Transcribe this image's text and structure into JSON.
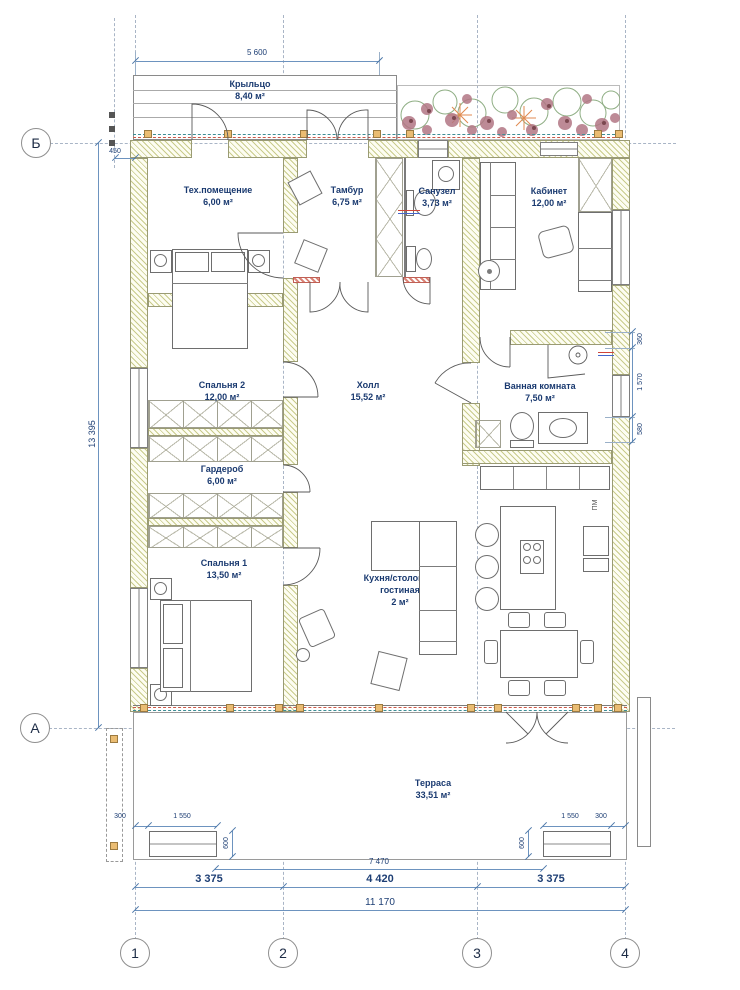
{
  "axes": {
    "horizontal": [
      "Б",
      "А"
    ],
    "vertical": [
      "1",
      "2",
      "3",
      "4"
    ]
  },
  "rooms": [
    {
      "name": "Крыльцо",
      "area": "8,40 м²"
    },
    {
      "name": "Тех.помещение",
      "area": "6,00 м²"
    },
    {
      "name": "Тамбур",
      "area": "6,75 м²"
    },
    {
      "name": "Санузел",
      "area": "3,73 м²"
    },
    {
      "name": "Кабинет",
      "area": "12,00 м²"
    },
    {
      "name": "Спальня 2",
      "area": "12,00 м²"
    },
    {
      "name": "Холл",
      "area": "15,52 м²"
    },
    {
      "name": "Ванная комната",
      "area": "7,50 м²"
    },
    {
      "name": "Гардероб",
      "area": "6,00 м²"
    },
    {
      "name": "Спальня 1",
      "area": "13,50 м²"
    },
    {
      "name": "Кухня/столовая/\nгостиная",
      "area": "2 м²"
    },
    {
      "name": "Терраса",
      "area": "33,51 м²"
    }
  ],
  "dims": {
    "porch_width": "5 600",
    "total_height": "13 395",
    "porch_offset": "450",
    "bath_seg_1": "360",
    "bath_seg_2": "1 570",
    "bath_seg_3": "580",
    "terr_left_offset": "300",
    "terr_left_bench": "1 550",
    "terr_left_depth": "600",
    "terr_right_bench": "1 550",
    "terr_right_offset": "300",
    "terr_right_depth": "600",
    "terrace_span": "7 470",
    "span_12": "3 375",
    "span_23": "4 420",
    "span_34": "3 375",
    "total_width": "11 170"
  },
  "labels": {
    "dishwasher": "ПМ"
  },
  "colors": {
    "dim_line": "#6d93bf",
    "label_text": "#1a3a70",
    "wall_hatch": "#c9cb8b",
    "post": "#eabc72"
  }
}
